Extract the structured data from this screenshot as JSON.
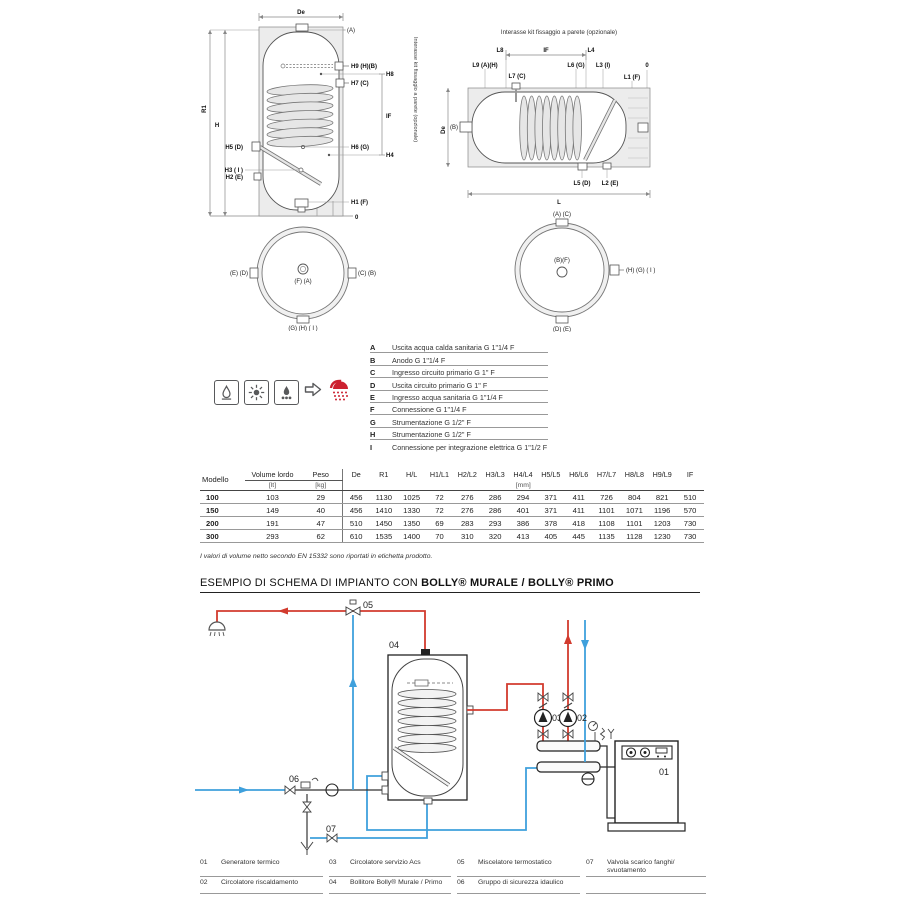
{
  "palette": {
    "red": "#d23b2e",
    "blue": "#3fa0dc",
    "gray": "#58595b"
  },
  "vdiag": {
    "de": "De",
    "a": "(A)",
    "h9": "H9 (H)(B)",
    "h8": "H8",
    "h7": "H7 (C)",
    "if": "IF",
    "h6": "H6 (G)",
    "h4": "H4",
    "h5": "H5 (D)",
    "h3": "H3 ( I )",
    "h2": "H2 (E)",
    "h1": "H1 (F)",
    "zero": "0",
    "r1": "R1",
    "h": "H",
    "note": "Interasse kit fissaggio a parete (opzionale)"
  },
  "hdiag": {
    "title": "Interasse kit fissaggio a parete (opzionale)",
    "l8": "L8",
    "if": "IF",
    "l4": "L4",
    "l9": "L9 (A)(H)",
    "l7": "L7 (C)",
    "l6": "L6 (G)",
    "l3": "L3 (I)",
    "l1": "L1 (F)",
    "zero": "0",
    "b": "(B)",
    "de": "De",
    "l5": "L5 (D)",
    "l2": "L2 (E)",
    "l": "L"
  },
  "view_v": {
    "left": "(E) (D)",
    "right": "(C) (B)",
    "center": "(F) (A)",
    "bottom": "(G) (H) ( I )"
  },
  "view_h": {
    "top": "(A) (C)",
    "center": "(B)(F)",
    "right": "(H) (G) ( I )",
    "bottom": "(D) (E)"
  },
  "connections": {
    "rows": [
      {
        "key": "A",
        "desc": "Uscita acqua calda sanitaria G 1\"1/4 F"
      },
      {
        "key": "B",
        "desc": "Anodo G 1\"1/4 F"
      },
      {
        "key": "C",
        "desc": "Ingresso circuito primario G 1\" F"
      },
      {
        "key": "D",
        "desc": "Uscita circuito primario G 1\" F"
      },
      {
        "key": "E",
        "desc": "Ingresso acqua sanitaria G 1\"1/4 F"
      },
      {
        "key": "F",
        "desc": "Connessione G 1\"1/4 F"
      },
      {
        "key": "G",
        "desc": "Strumentazione G 1/2\" F"
      },
      {
        "key": "H",
        "desc": "Strumentazione G 1/2\" F"
      },
      {
        "key": "I",
        "desc": "Connessione per integrazione elettrica G 1\"1/2 F"
      }
    ]
  },
  "energy": {
    "icons": [
      "gas-flame-icon",
      "sun-icon",
      "solid-fuel-icon"
    ],
    "arrow_icon": "arrow-right-icon",
    "result_icon": "shower-icon"
  },
  "table": {
    "col_model": "Modello",
    "col_volume": "Volume lordo",
    "col_volume_unit": "[lt]",
    "col_weight": "Peso",
    "col_weight_unit": "[kg]",
    "dim_headers": [
      "De",
      "R1",
      "H/L",
      "H1/L1",
      "H2/L2",
      "H3/L3",
      "H4/L4",
      "H5/L5",
      "H6/L6",
      "H7/L7",
      "H8/L8",
      "H9/L9",
      "IF"
    ],
    "dim_unit": "[mm]",
    "rows": [
      {
        "model": "100",
        "volume": "103",
        "weight": "29",
        "dims": [
          "456",
          "1130",
          "1025",
          "72",
          "276",
          "286",
          "294",
          "371",
          "411",
          "726",
          "804",
          "821",
          "510"
        ]
      },
      {
        "model": "150",
        "volume": "149",
        "weight": "40",
        "dims": [
          "456",
          "1410",
          "1330",
          "72",
          "276",
          "286",
          "401",
          "371",
          "411",
          "1101",
          "1071",
          "1196",
          "570"
        ]
      },
      {
        "model": "200",
        "volume": "191",
        "weight": "47",
        "dims": [
          "510",
          "1450",
          "1350",
          "69",
          "283",
          "293",
          "386",
          "378",
          "418",
          "1108",
          "1101",
          "1203",
          "730"
        ]
      },
      {
        "model": "300",
        "volume": "293",
        "weight": "62",
        "dims": [
          "610",
          "1535",
          "1400",
          "70",
          "310",
          "320",
          "413",
          "405",
          "445",
          "1135",
          "1128",
          "1230",
          "730"
        ]
      }
    ],
    "footnote": "I valori di volume netto secondo EN 15332 sono riportati in etichetta prodotto."
  },
  "schema": {
    "title_regular": "ESEMPIO DI SCHEMA DI IMPIANTO CON ",
    "title_bold": "BOLLY® MURALE / BOLLY® PRIMO",
    "callouts": {
      "c01": "01",
      "c02": "02",
      "c03": "03",
      "c04": "04",
      "c05": "05",
      "c06": "06",
      "c07": "07"
    },
    "legend": [
      {
        "num": "01",
        "desc": "Generatore termico"
      },
      {
        "num": "02",
        "desc": "Circolatore riscaldamento"
      },
      {
        "num": "03",
        "desc": "Circolatore servizio Acs"
      },
      {
        "num": "04",
        "desc": "Bollitore Bolly® Murale / Primo"
      },
      {
        "num": "05",
        "desc": "Miscelatore termostatico"
      },
      {
        "num": "06",
        "desc": "Gruppo di sicurezza idaulico"
      },
      {
        "num": "07",
        "desc": "Valvola scarico fanghi/ svuotamento"
      }
    ]
  }
}
